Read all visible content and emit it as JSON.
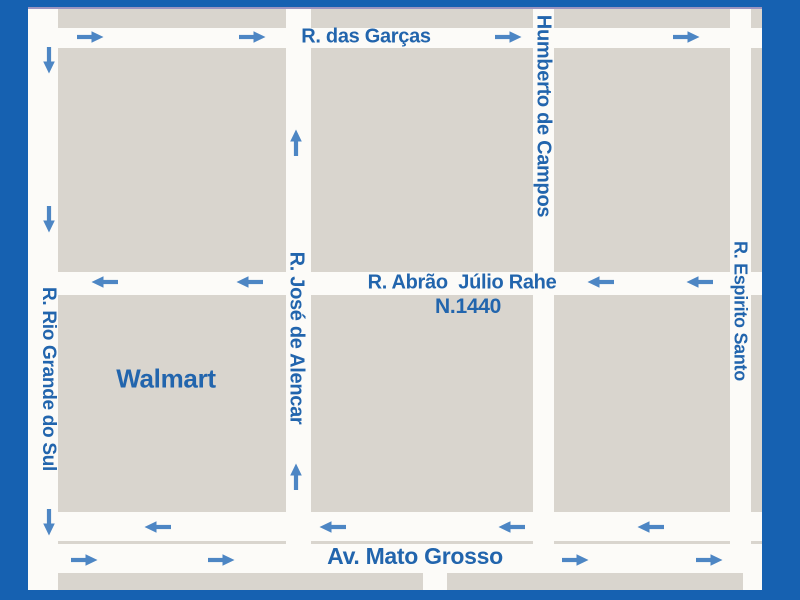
{
  "map": {
    "offset": {
      "x": 28,
      "y": 7,
      "width": 734,
      "height": 583
    },
    "colors": {
      "border_blue": "#1661b1",
      "canvas_white": "#fcfbf8",
      "block_beige": "#d9d5ce",
      "label_blue": "#2265ad",
      "arrow_blue": "#4d86c4",
      "top_edge_line": "#9d95c0"
    },
    "blocks": [
      [
        30,
        2,
        228,
        19
      ],
      [
        283,
        2,
        222,
        19
      ],
      [
        526,
        2,
        176,
        19
      ],
      [
        723,
        2,
        11,
        19
      ],
      [
        30,
        41,
        228,
        224
      ],
      [
        283,
        41,
        222,
        224
      ],
      [
        526,
        41,
        176,
        224
      ],
      [
        723,
        41,
        11,
        224
      ],
      [
        30,
        288,
        228,
        217
      ],
      [
        283,
        288,
        222,
        217
      ],
      [
        526,
        288,
        176,
        217
      ],
      [
        723,
        288,
        11,
        217
      ],
      [
        30,
        534,
        228,
        3
      ],
      [
        283,
        534,
        222,
        3
      ],
      [
        526,
        534,
        176,
        3
      ],
      [
        723,
        534,
        11,
        3
      ],
      [
        30,
        566,
        365,
        17
      ],
      [
        419,
        566,
        296,
        17
      ]
    ],
    "streets": [
      {
        "id": "r-das-garcas",
        "name": "R. das Garças",
        "orientation": "horizontal",
        "label_x": 338,
        "label_y": 30,
        "font_size": 20
      },
      {
        "id": "r-abrao-julio-rahe",
        "name": "R. Abrão  Júlio Rahe",
        "orientation": "horizontal",
        "label_x": 434,
        "label_y": 276,
        "font_size": 20
      },
      {
        "id": "av-mato-grosso",
        "name": "Av. Mato Grosso",
        "orientation": "horizontal",
        "label_x": 387,
        "label_y": 549,
        "font_size": 23
      },
      {
        "id": "r-rio-grande-do-sul",
        "name": "R. Rio Grande do Sul",
        "orientation": "vertical",
        "label_x": 20,
        "label_y": 372,
        "font_size": 19
      },
      {
        "id": "r-jose-de-alencar",
        "name": "R. José de Alencar",
        "orientation": "vertical",
        "label_x": 268,
        "label_y": 331,
        "font_size": 20
      },
      {
        "id": "humberto-de-campos",
        "name": "Humberto de Campos",
        "orientation": "vertical",
        "label_x": 515,
        "label_y": 109,
        "font_size": 20
      },
      {
        "id": "r-espirito-santo",
        "name": "R. Espirito Santo",
        "orientation": "vertical",
        "label_x": 712,
        "label_y": 304,
        "font_size": 18
      }
    ],
    "address_marker": {
      "text": "N.1440",
      "x": 440,
      "y": 300,
      "font_size": 21
    },
    "arrows": [
      {
        "dir": "right",
        "x": 62,
        "y": 30
      },
      {
        "dir": "right",
        "x": 224,
        "y": 30
      },
      {
        "dir": "right",
        "x": 480,
        "y": 30
      },
      {
        "dir": "right",
        "x": 658,
        "y": 30
      },
      {
        "dir": "left",
        "x": 77,
        "y": 275
      },
      {
        "dir": "left",
        "x": 222,
        "y": 275
      },
      {
        "dir": "left",
        "x": 573,
        "y": 275
      },
      {
        "dir": "left",
        "x": 672,
        "y": 275
      },
      {
        "dir": "down",
        "x": 21,
        "y": 53
      },
      {
        "dir": "down",
        "x": 21,
        "y": 212
      },
      {
        "dir": "down",
        "x": 21,
        "y": 515
      },
      {
        "dir": "up",
        "x": 268,
        "y": 136
      },
      {
        "dir": "up",
        "x": 268,
        "y": 470
      },
      {
        "dir": "left",
        "x": 130,
        "y": 520
      },
      {
        "dir": "left",
        "x": 305,
        "y": 520
      },
      {
        "dir": "left",
        "x": 484,
        "y": 520
      },
      {
        "dir": "left",
        "x": 623,
        "y": 520
      },
      {
        "dir": "right",
        "x": 56,
        "y": 553
      },
      {
        "dir": "right",
        "x": 193,
        "y": 553
      },
      {
        "dir": "right",
        "x": 547,
        "y": 553
      },
      {
        "dir": "right",
        "x": 681,
        "y": 553
      }
    ],
    "pois": {
      "walmart": {
        "label": "Walmart",
        "icon": "shopping-cart-icon",
        "circle_color": "#154a68",
        "label_x": 138,
        "label_y": 372,
        "font_size": 26,
        "cx": 140,
        "cy": 424,
        "r": 33
      },
      "unisaude": {
        "name": "UNISAÚDE",
        "suffix": "MS",
        "icon": "medical-cross-flag-icon",
        "bg_color": "#3c3a8f",
        "circle_color": "#3fc4f0",
        "cross_color": "#e23b3b",
        "suffix_color": "#8ab4e0",
        "x": 380,
        "y": 317,
        "width": 102,
        "height": 100
      }
    }
  }
}
